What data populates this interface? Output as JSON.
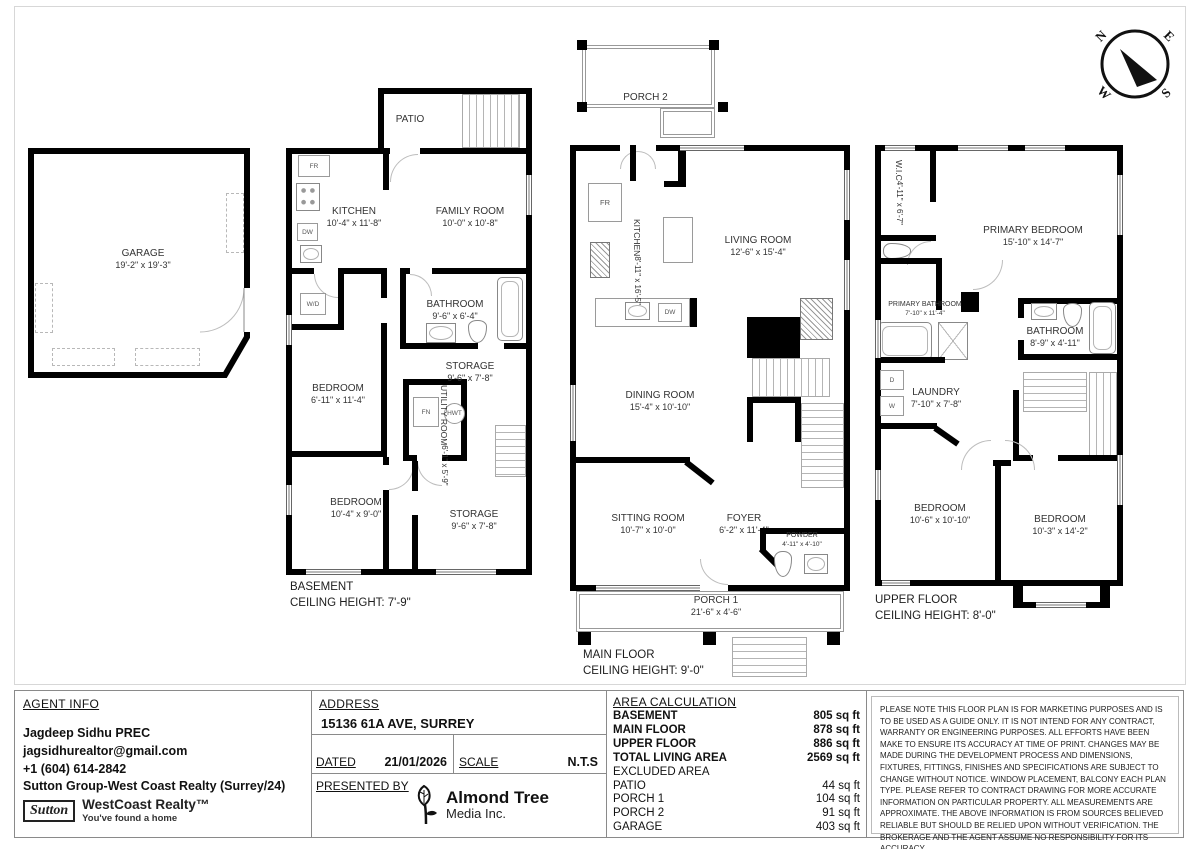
{
  "compass": {
    "n": "N",
    "e": "E",
    "s": "S",
    "w": "W"
  },
  "plans": {
    "garage": {
      "rooms": [
        {
          "name": "GARAGE",
          "dims": "19'-2\" x 19'-3\""
        }
      ]
    },
    "basement": {
      "caption1": "BASEMENT",
      "caption2": "CEILING HEIGHT: 7'-9\"",
      "rooms": [
        {
          "name": "PATIO",
          "dims": ""
        },
        {
          "name": "KITCHEN",
          "dims": "10'-4\" x 11'-8\""
        },
        {
          "name": "FAMILY ROOM",
          "dims": "10'-0\" x 10'-8\""
        },
        {
          "name": "BATHROOM",
          "dims": "9'-6\" x 6'-4\""
        },
        {
          "name": "STORAGE",
          "dims": "9'-6\" x 7'-8\""
        },
        {
          "name": "UTILITY ROOM",
          "dims": "6'-1\" x 5'-9\""
        },
        {
          "name": "BEDROOM",
          "dims": "6'-11\" x 11'-4\""
        },
        {
          "name": "BEDROOM",
          "dims": "10'-4\" x 9'-0\""
        },
        {
          "name": "STORAGE",
          "dims": "9'-6\" x 7'-8\""
        }
      ],
      "fx": {
        "fr": "FR",
        "dw": "DW",
        "wd": "W/D",
        "fn": "FN",
        "hwt": "HWT"
      }
    },
    "main": {
      "caption1": "MAIN FLOOR",
      "caption2": "CEILING HEIGHT: 9'-0\"",
      "rooms": [
        {
          "name": "PORCH 2",
          "dims": ""
        },
        {
          "name": "KITCHEN",
          "dims": "8'-11\" x 16'-5\""
        },
        {
          "name": "LIVING ROOM",
          "dims": "12'-6\" x 15'-4\""
        },
        {
          "name": "DINING ROOM",
          "dims": "15'-4\" x 10'-10\""
        },
        {
          "name": "SITTING ROOM",
          "dims": "10'-7\" x 10'-0\""
        },
        {
          "name": "FOYER",
          "dims": "6'-2\" x 11'-4\""
        },
        {
          "name": "POWDER",
          "dims": "4'-11\" x 4'-10\""
        },
        {
          "name": "PORCH 1",
          "dims": "21'-6\" x 4'-6\""
        }
      ],
      "fx": {
        "fr": "FR",
        "dw": "DW"
      }
    },
    "upper": {
      "caption1": "UPPER FLOOR",
      "caption2": "CEILING HEIGHT: 8'-0\"",
      "rooms": [
        {
          "name": "W.I.C",
          "dims": "4'-11\" x 6'-7\""
        },
        {
          "name": "PRIMARY BEDROOM",
          "dims": "15'-10\" x 14'-7\""
        },
        {
          "name": "PRIMARY BATHROOM",
          "dims": "7'-10\" x 11'-4\""
        },
        {
          "name": "BATHROOM",
          "dims": "8'-9\" x 4'-11\""
        },
        {
          "name": "LAUNDRY",
          "dims": "7'-10\" x 7'-8\""
        },
        {
          "name": "BEDROOM",
          "dims": "10'-6\" x 10'-10\""
        },
        {
          "name": "BEDROOM",
          "dims": "10'-3\" x 14'-2\""
        }
      ],
      "fx": {
        "d": "D",
        "w": "W"
      }
    }
  },
  "title_block": {
    "agent": {
      "heading": "AGENT INFO",
      "name": "Jagdeep Sidhu PREC",
      "email": "jagsidhurealtor@gmail.com",
      "phone": "+1 (604) 614-2842",
      "brokerage": "Sutton Group-West Coast Realty (Surrey/24)",
      "logo_script": "Sutton",
      "logo_main": "WestCoast Realty™",
      "logo_tag": "You've found a home"
    },
    "address": {
      "heading": "ADDRESS",
      "value": "15136 61A AVE, SURREY",
      "dated_label": "DATED",
      "dated_value": "21/01/2026",
      "scale_label": "SCALE",
      "scale_value": "N.T.S",
      "presented_label": "PRESENTED BY",
      "media_name": "Almond Tree",
      "media_sub": "Media Inc."
    },
    "area": {
      "heading": "AREA CALCULATION",
      "rows": [
        {
          "label": "BASEMENT",
          "value": "805 sq ft"
        },
        {
          "label": "MAIN FLOOR",
          "value": "878 sq ft"
        },
        {
          "label": "UPPER FLOOR",
          "value": "886 sq ft"
        },
        {
          "label": "TOTAL LIVING AREA",
          "value": "2569 sq ft"
        },
        {
          "label": "EXCLUDED AREA",
          "value": ""
        },
        {
          "label": "PATIO",
          "value": "44 sq ft"
        },
        {
          "label": "PORCH 1",
          "value": "104 sq ft"
        },
        {
          "label": "PORCH 2",
          "value": "91 sq ft"
        },
        {
          "label": "GARAGE",
          "value": "403 sq ft"
        }
      ]
    },
    "disclaimer": "PLEASE NOTE THIS FLOOR PLAN IS FOR MARKETING PURPOSES AND IS TO BE USED AS A GUIDE ONLY. IT IS NOT INTEND FOR ANY CONTRACT, WARRANTY OR ENGINEERING PURPOSES. ALL EFFORTS HAVE BEEN MAKE TO ENSURE ITS ACCURACY AT TIME OF PRINT. CHANGES MAY BE MADE DURING THE DEVELOPMENT PROCESS AND DIMENSIONS, FIXTURES, FITTINGS, FINISHES AND SPECIFICATIONS ARE SUBJECT TO CHANGE WITHOUT NOTICE. WINDOW PLACEMENT, BALCONY EACH PLAN TYPE. PLEASE REFER TO CONTRACT DRAWING FOR MORE ACCURATE INFORMATION ON PARTICULAR PROPERTY. ALL MEASUREMENTS ARE APPROXIMATE. THE ABOVE INFORMATION IS FROM SOURCES BELIEVED RELIABLE BUT SHOULD BE RELIED UPON WITHOUT VERIFICATION. THE BROKERAGE AND THE AGENT ASSUME NO RESPONSIBILITY FOR ITS ACCURACY."
  }
}
